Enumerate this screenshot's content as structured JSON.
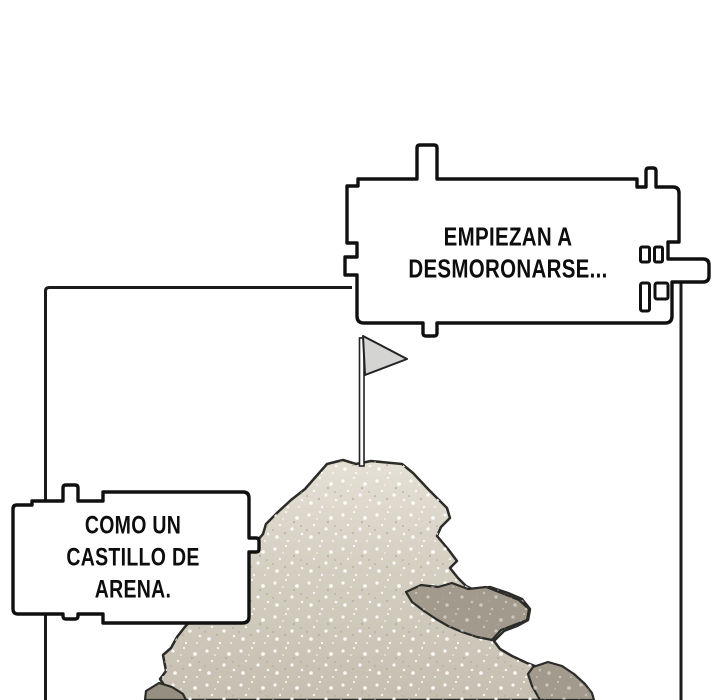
{
  "page": {
    "background": "#ffffff"
  },
  "bubbles": {
    "top": {
      "text": "EMPIEZAN A\nDESMORONARSE...",
      "shape": "castle-block-bubble"
    },
    "left": {
      "text": "COMO UN\nCASTILLO DE\nARENA.",
      "shape": "castle-block-bubble"
    }
  },
  "scene": {
    "flag": "flag-icon",
    "mound": "sand-castle-mound",
    "crumbles": [
      "right-chunk",
      "bottom-right-chunk",
      "bottom-left-chunk"
    ]
  },
  "colors": {
    "outline": "#101010",
    "panel_border": "#1b1b1b",
    "bubble_fill": "#ffffff",
    "sand_top": "#e5e0d5",
    "sand_mid": "#d5cfc2",
    "sand_bottom": "#c6bfb1",
    "chunk": "#a29a8c",
    "chunk_dark": "#968e80",
    "flag": "#d4d4d3",
    "pole": "#fdfdfd",
    "text": "#0d0d0d"
  }
}
